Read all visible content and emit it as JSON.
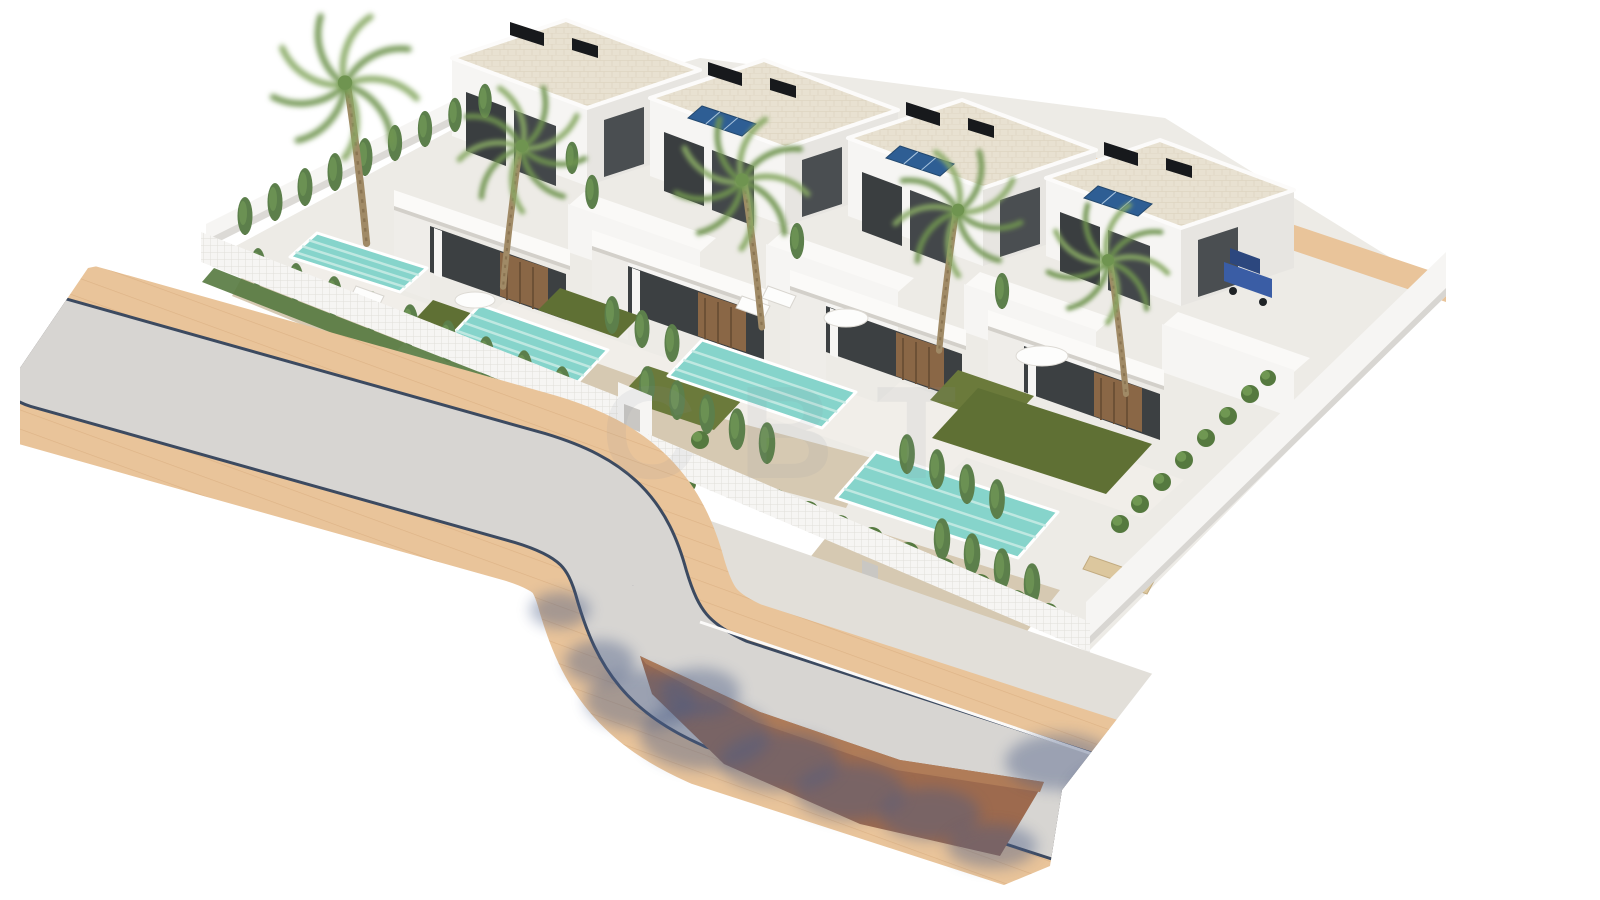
{
  "meta": {
    "description": "3D architectural rendering of a residential development: a row of four modern white two-storey villas, each with a private turquoise pool, lawn, gravel garden, cypress and palm trees, enclosed by white walls and lattice fences; a curved grey road with beige paver sidewalks passes in front, with tree shadows and a terracotta embankment at the bottom; one blue car is parked beside the rightmost villa.",
    "villas_count": 4,
    "canvas": {
      "width": 1600,
      "height": 900
    }
  },
  "watermark": {
    "text": "CBT"
  },
  "colors": {
    "background": "#ffffff",
    "road": "#d7d5d2",
    "sidewalk": "#e9c49a",
    "paver_line": "#cf9f6f",
    "curb": "#3c4a60",
    "walkway": "#e2dfd9",
    "embankment": "#9d6a4e",
    "shadow": "#4a5c85",
    "plot_ground": "#edebe6",
    "terrace_pad": "#f1eee9",
    "wall_white": "#f6f5f3",
    "wall_shade": "#e7e5e1",
    "roof_stone": "#e8e1d1",
    "window_dark": "#3c4042",
    "wood_door": "#8a6746",
    "solar_panel": "#2e5e94",
    "solar_grid": "#a9c4de",
    "ac_unit": "#17191c",
    "pool_water": "#86d4cb",
    "pool_ripple": "#c9ece6",
    "lawn": "#6b7a3b",
    "lawn_dark": "#5f7034",
    "gravel": "#d6c9b2",
    "shrub": "#55793f",
    "shrub_light": "#7aa45b",
    "cypress": "#5c7f4b",
    "palm_frond": "#87a964",
    "palm_trunk": "#a08a66",
    "car_blue": "#3a5da5",
    "car_roof": "#2c477e",
    "furniture_white": "#fdfdfc",
    "furniture_wood": "#dcc79e",
    "watermark": "#8b94a0"
  },
  "scene": {
    "plot": [
      [
        206,
        262
      ],
      [
        470,
        120
      ],
      [
        700,
        58
      ],
      [
        1165,
        118
      ],
      [
        1446,
        292
      ],
      [
        1088,
        652
      ],
      [
        652,
        438
      ],
      [
        622,
        424
      ]
    ],
    "villas": [
      {
        "id": "villa-1",
        "dx": 0,
        "dy": 0
      },
      {
        "id": "villa-2",
        "dx": 198,
        "dy": 40
      },
      {
        "id": "villa-3",
        "dx": 396,
        "dy": 80
      },
      {
        "id": "villa-4",
        "dx": 594,
        "dy": 120
      }
    ],
    "solar_panels": [
      [
        [
          688,
          118
        ],
        [
          742,
          136
        ],
        [
          756,
          124
        ],
        [
          702,
          106
        ]
      ],
      [
        [
          886,
          158
        ],
        [
          940,
          176
        ],
        [
          954,
          164
        ],
        [
          900,
          146
        ]
      ],
      [
        [
          1084,
          198
        ],
        [
          1138,
          216
        ],
        [
          1152,
          204
        ],
        [
          1098,
          186
        ]
      ]
    ],
    "pools": [
      [
        [
          317,
          233
        ],
        [
          427,
          268
        ],
        [
          400,
          292
        ],
        [
          290,
          257
        ]
      ],
      [
        [
          480,
          305
        ],
        [
          608,
          350
        ],
        [
          578,
          382
        ],
        [
          450,
          337
        ]
      ],
      [
        [
          702,
          340
        ],
        [
          856,
          392
        ],
        [
          822,
          428
        ],
        [
          668,
          376
        ]
      ],
      [
        [
          876,
          452
        ],
        [
          1058,
          512
        ],
        [
          1018,
          558
        ],
        [
          836,
          498
        ]
      ]
    ],
    "lawns": [
      {
        "points": [
          [
            433,
            300
          ],
          [
            505,
            325
          ],
          [
            480,
            352
          ],
          [
            408,
            327
          ]
        ],
        "dark": true
      },
      {
        "points": [
          [
            560,
            288
          ],
          [
            640,
            316
          ],
          [
            618,
            338
          ],
          [
            538,
            310
          ]
        ],
        "dark": true
      },
      {
        "points": [
          [
            648,
            366
          ],
          [
            744,
            398
          ],
          [
            714,
            430
          ],
          [
            618,
            398
          ]
        ],
        "dark": false
      },
      {
        "points": [
          [
            958,
            370
          ],
          [
            1034,
            396
          ],
          [
            1006,
            426
          ],
          [
            930,
            400
          ]
        ],
        "dark": false
      },
      {
        "points": [
          [
            978,
            388
          ],
          [
            1152,
            444
          ],
          [
            1106,
            494
          ],
          [
            932,
            438
          ]
        ],
        "dark": true
      }
    ],
    "gravel_beds": [
      [
        [
          250,
          262
        ],
        [
          420,
          326
        ],
        [
          388,
          360
        ],
        [
          232,
          296
        ]
      ],
      [
        [
          560,
          350
        ],
        [
          700,
          400
        ],
        [
          668,
          446
        ],
        [
          528,
          396
        ]
      ],
      [
        [
          660,
          402
        ],
        [
          872,
          458
        ],
        [
          846,
          508
        ],
        [
          634,
          452
        ]
      ],
      [
        [
          840,
          520
        ],
        [
          1060,
          590
        ],
        [
          1020,
          640
        ],
        [
          800,
          570
        ]
      ]
    ],
    "hedgerows": [
      [
        [
          214,
          268
        ],
        [
          612,
          424
        ],
        [
          600,
          438
        ],
        [
          202,
          282
        ]
      ],
      [
        [
          656,
          446
        ],
        [
          1084,
          626
        ],
        [
          1072,
          642
        ],
        [
          644,
          462
        ]
      ]
    ],
    "cypresses": [
      [
        245,
        235,
        1
      ],
      [
        275,
        221,
        1
      ],
      [
        305,
        206,
        1
      ],
      [
        335,
        191,
        1
      ],
      [
        365,
        176,
        1
      ],
      [
        395,
        161,
        0.95
      ],
      [
        425,
        147,
        0.95
      ],
      [
        455,
        132,
        0.9
      ],
      [
        485,
        118,
        0.9
      ],
      [
        258,
        286,
        1
      ],
      [
        296,
        301,
        1
      ],
      [
        334,
        316,
        1.05
      ],
      [
        372,
        331,
        1.05
      ],
      [
        410,
        346,
        1.1
      ],
      [
        448,
        362,
        1.1
      ],
      [
        486,
        378,
        1.1
      ],
      [
        524,
        394,
        1.15
      ],
      [
        562,
        410,
        1.15
      ],
      [
        612,
        334,
        1
      ],
      [
        642,
        348,
        1
      ],
      [
        672,
        362,
        1
      ],
      [
        647,
        406,
        1.05
      ],
      [
        677,
        420,
        1.05
      ],
      [
        707,
        434,
        1.05
      ],
      [
        737,
        450,
        1.1
      ],
      [
        767,
        464,
        1.1
      ],
      [
        907,
        474,
        1.05
      ],
      [
        937,
        489,
        1.05
      ],
      [
        967,
        504,
        1.05
      ],
      [
        997,
        519,
        1.05
      ],
      [
        942,
        560,
        1.1
      ],
      [
        972,
        575,
        1.1
      ],
      [
        1002,
        590,
        1.1
      ],
      [
        1032,
        605,
        1.1
      ],
      [
        592,
        209,
        0.9
      ],
      [
        797,
        259,
        0.95
      ],
      [
        1002,
        309,
        0.95
      ],
      [
        572,
        174,
        0.85
      ]
    ],
    "shrubs": [
      [
        712,
        474,
        10
      ],
      [
        744,
        487,
        11
      ],
      [
        776,
        499,
        10
      ],
      [
        808,
        512,
        11
      ],
      [
        840,
        525,
        10
      ],
      [
        700,
        440,
        9
      ],
      [
        872,
        538,
        11
      ],
      [
        908,
        553,
        11
      ],
      [
        944,
        569,
        11
      ],
      [
        980,
        585,
        11
      ],
      [
        1016,
        601,
        11
      ],
      [
        1048,
        613,
        10
      ],
      [
        630,
        448,
        9
      ],
      [
        602,
        432,
        9
      ],
      [
        868,
        544,
        9
      ],
      [
        1140,
        504,
        9
      ],
      [
        1162,
        482,
        9
      ],
      [
        1184,
        460,
        9
      ],
      [
        1206,
        438,
        9
      ],
      [
        1228,
        416,
        9
      ],
      [
        1250,
        394,
        9
      ],
      [
        1268,
        378,
        8
      ],
      [
        1120,
        524,
        9
      ],
      [
        660,
        470,
        8
      ],
      [
        688,
        484,
        8
      ]
    ],
    "palms": [
      [
        345,
        85,
        1.2,
        1
      ],
      [
        522,
        148,
        1.05,
        -1
      ],
      [
        742,
        182,
        1.1,
        1
      ],
      [
        958,
        212,
        1.05,
        -1
      ],
      [
        1108,
        262,
        1.0,
        1
      ]
    ],
    "shadows": [
      [
        640,
        700,
        55,
        30
      ],
      [
        705,
        735,
        65,
        35
      ],
      [
        780,
        762,
        60,
        30
      ],
      [
        850,
        792,
        55,
        28
      ],
      [
        930,
        814,
        50,
        26
      ],
      [
        600,
        662,
        35,
        22
      ],
      [
        1060,
        762,
        55,
        28
      ],
      [
        1130,
        792,
        60,
        30
      ],
      [
        1205,
        800,
        50,
        26
      ],
      [
        1262,
        778,
        38,
        22
      ],
      [
        992,
        846,
        45,
        22
      ],
      [
        700,
        692,
        40,
        24
      ],
      [
        560,
        610,
        30,
        18
      ]
    ],
    "car": {
      "body": [
        [
          1224,
          262
        ],
        [
          1272,
          279
        ],
        [
          1272,
          298
        ],
        [
          1224,
          281
        ]
      ],
      "roof": [
        [
          1230,
          248
        ],
        [
          1260,
          259
        ],
        [
          1260,
          274
        ],
        [
          1230,
          263
        ]
      ],
      "wheels": [
        [
          1233,
          291
        ],
        [
          1263,
          302
        ]
      ]
    },
    "furniture": {
      "loungers_white": [
        [
          [
            330,
            296
          ],
          [
            358,
            306
          ],
          [
            352,
            318
          ],
          [
            324,
            308
          ]
        ],
        [
          [
            356,
            286
          ],
          [
            384,
            296
          ],
          [
            378,
            308
          ],
          [
            350,
            298
          ]
        ],
        [
          [
            742,
            296
          ],
          [
            770,
            306
          ],
          [
            764,
            318
          ],
          [
            736,
            308
          ]
        ],
        [
          [
            768,
            286
          ],
          [
            796,
            296
          ],
          [
            790,
            308
          ],
          [
            762,
            298
          ]
        ]
      ],
      "loungers_wood": [
        [
          [
            1090,
            556
          ],
          [
            1122,
            567
          ],
          [
            1115,
            580
          ],
          [
            1083,
            569
          ]
        ],
        [
          [
            1122,
            570
          ],
          [
            1154,
            581
          ],
          [
            1147,
            594
          ],
          [
            1115,
            583
          ]
        ]
      ],
      "sofas": [
        [
          846,
          318,
          22,
          9
        ],
        [
          1042,
          356,
          26,
          10
        ],
        [
          475,
          300,
          20,
          8
        ]
      ]
    }
  }
}
